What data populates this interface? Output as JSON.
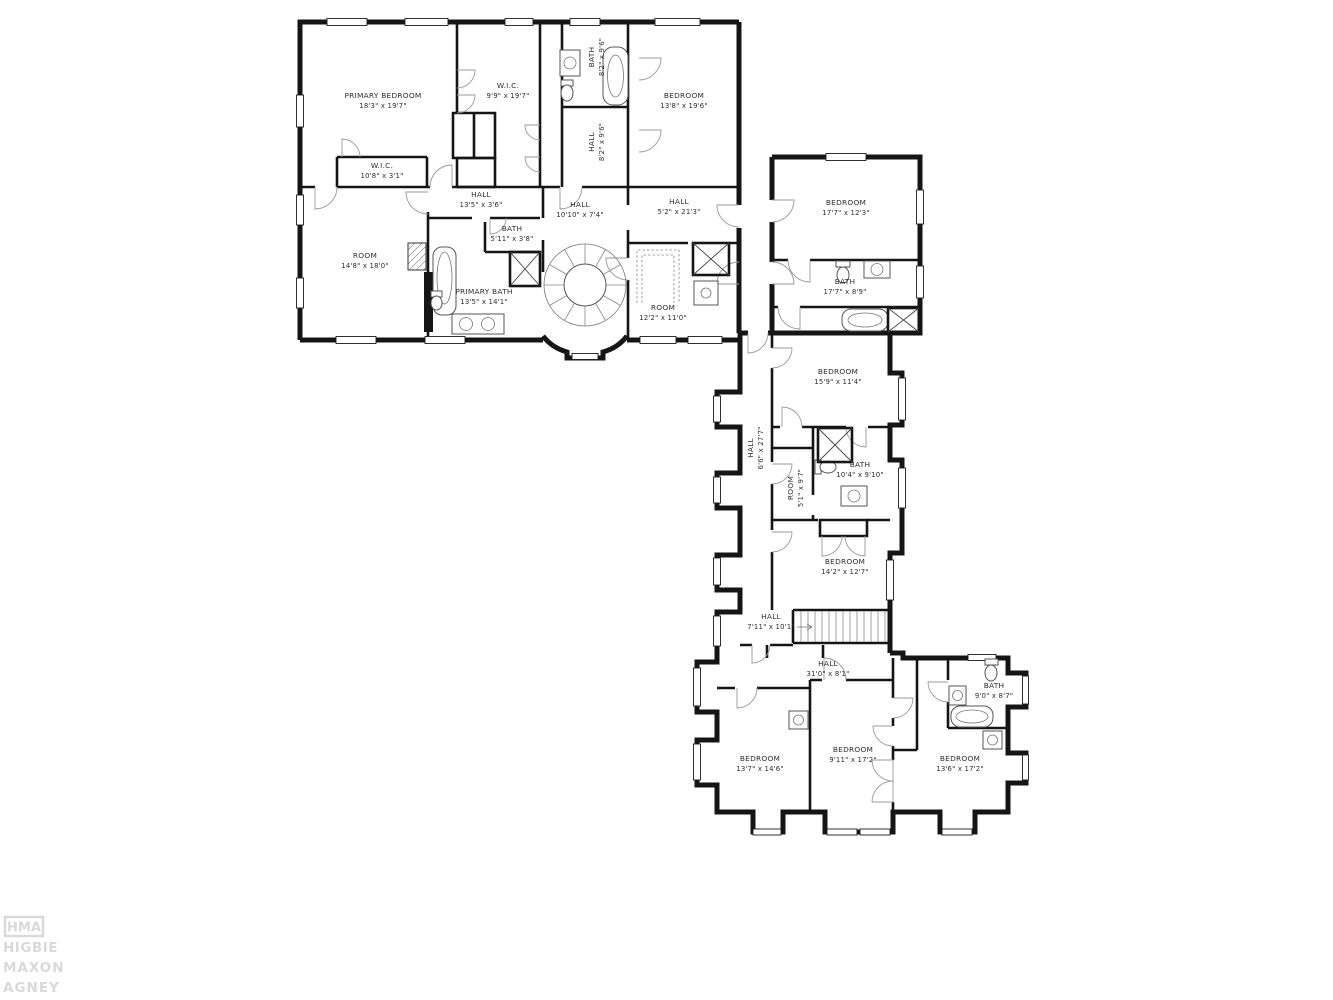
{
  "watermark": {
    "logo": "HMA",
    "lines": [
      "HIGBIE",
      "MAXON",
      "AGNEY"
    ]
  },
  "rooms": [
    {
      "name": "PRIMARY BEDROOM",
      "dims": "18'3\" x 19'7\""
    },
    {
      "name": "W.I.C.",
      "dims": "9'9\" x 19'7\""
    },
    {
      "name": "BATH",
      "dims": "8'2\" x 9'6\""
    },
    {
      "name": "HALL",
      "dims": "8'2\" x 9'6\""
    },
    {
      "name": "BEDROOM",
      "dims": "13'8\" x 19'6\""
    },
    {
      "name": "W.I.C.",
      "dims": "10'8\" x 3'1\""
    },
    {
      "name": "HALL",
      "dims": "13'5\" x 3'6\""
    },
    {
      "name": "ROOM",
      "dims": "14'8\" x 18'0\""
    },
    {
      "name": "BATH",
      "dims": "5'11\" x 3'8\""
    },
    {
      "name": "PRIMARY BATH",
      "dims": "13'5\" x 14'1\""
    },
    {
      "name": "HALL",
      "dims": "10'10\" x 7'4\""
    },
    {
      "name": "HALL",
      "dims": "5'2\" x 21'3\""
    },
    {
      "name": "ROOM",
      "dims": "12'2\" x 11'0\""
    },
    {
      "name": "BEDROOM",
      "dims": "17'7\" x 12'3\""
    },
    {
      "name": "BATH",
      "dims": "17'7\" x 8'9\""
    },
    {
      "name": "BEDROOM",
      "dims": "15'9\" x 11'4\""
    },
    {
      "name": "HALL",
      "dims": "6'6\" x 27'7\""
    },
    {
      "name": "ROOM",
      "dims": "5'1\" x 9'7\""
    },
    {
      "name": "BATH",
      "dims": "10'4\" x 9'10\""
    },
    {
      "name": "BEDROOM",
      "dims": "14'2\" x 12'7\""
    },
    {
      "name": "HALL",
      "dims": "7'11\" x 10'1\""
    },
    {
      "name": "HALL",
      "dims": "31'0\" x 8'1\""
    },
    {
      "name": "BATH",
      "dims": "9'0\" x 8'7\""
    },
    {
      "name": "BEDROOM",
      "dims": "13'7\" x 14'6\""
    },
    {
      "name": "BEDROOM",
      "dims": "9'11\" x 17'2\""
    },
    {
      "name": "BEDROOM",
      "dims": "13'6\" x 17'2\""
    }
  ]
}
